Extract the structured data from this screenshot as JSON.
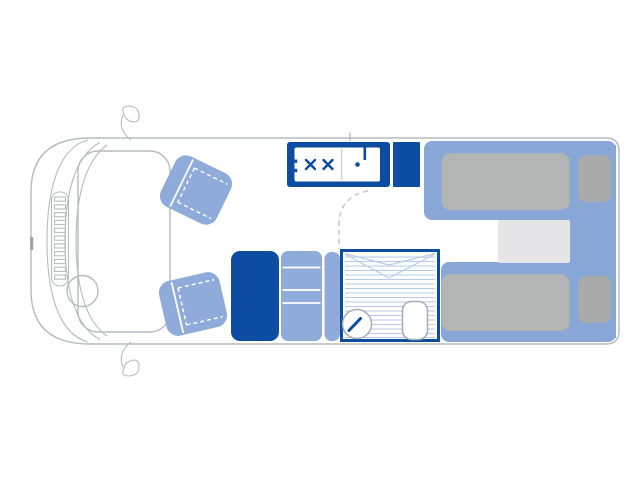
{
  "diagram": {
    "type": "motorhome-floorplan",
    "view": "top-down",
    "vehicle": {
      "orientation": "front-left-rear-right",
      "cab": {
        "swivel_seats": 2,
        "steering_wheel_side": "lower",
        "mirrors": [
          "top",
          "bottom"
        ],
        "grille_bars": 11
      },
      "kitchen": {
        "hob_burners": 2,
        "sink": "single-bowl-with-tap",
        "tall_cabinet_beside_hob": true,
        "lower_cabinet_sections": 4,
        "wardrobe": true,
        "door_swing": "dashed-arc"
      },
      "bathroom": {
        "shower_tray": "lined",
        "washbasin": "round-with-tap",
        "toilet": true
      },
      "bedroom": {
        "bed_type": "twin-single-beds-rear",
        "mattresses": 2,
        "pillows": 2,
        "center_step": true
      }
    }
  },
  "colors": {
    "dark_blue": "#0c4da2",
    "light_blue": "#8fabd9",
    "bed_blue": "#88a6d6",
    "mattress_gray": "#b3b5b5",
    "pillow_gray": "#a9abab",
    "step_gray": "#e6e6e8",
    "outline_gray": "#b7bbbf",
    "fixture_gray": "#a6abb0",
    "shower_line": "#b6cbe7",
    "divider_gray": "#ccd1d6",
    "dash_gray": "#c3c7cb",
    "white": "#ffffff"
  }
}
